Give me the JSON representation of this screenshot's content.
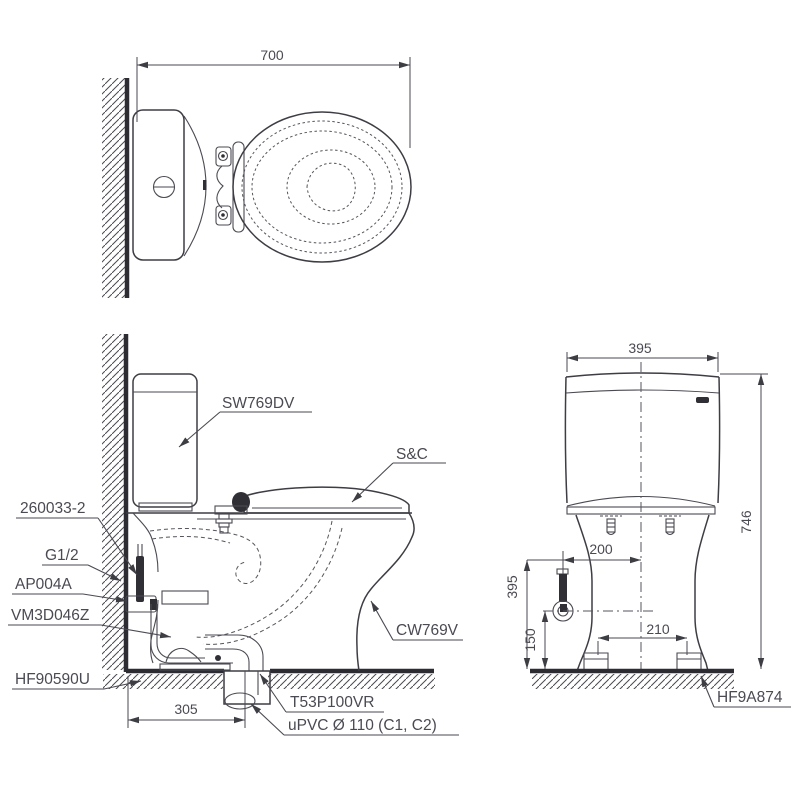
{
  "drawing": {
    "top_view": {
      "width_dim": "700"
    },
    "side_view": {
      "rough_in_dim": "305",
      "labels": {
        "cistern": "SW769DV",
        "seat": "S&C",
        "supply_hose": "260033-2",
        "supply_thread": "G1/2",
        "angle_valve": "AP004A",
        "flush_valve": "VM3D046Z",
        "floor_flange": "HF90590U",
        "bowl": "CW769V",
        "outlet_socket": "T53P100VR",
        "drain_pipe": "uPVC Ø 110 (C1, C2)"
      }
    },
    "front_view": {
      "width_dim": "395",
      "total_height_dim": "746",
      "rim_height_dim": "395",
      "supply_height_dim": "150",
      "supply_offset_dim": "200",
      "bolt_spacing_dim": "210",
      "fixing_label": "HF9A874"
    },
    "colors": {
      "line": "#3d3d44",
      "heavy_line": "#2c2c32",
      "text": "#4a4a52",
      "background": "#ffffff"
    }
  }
}
